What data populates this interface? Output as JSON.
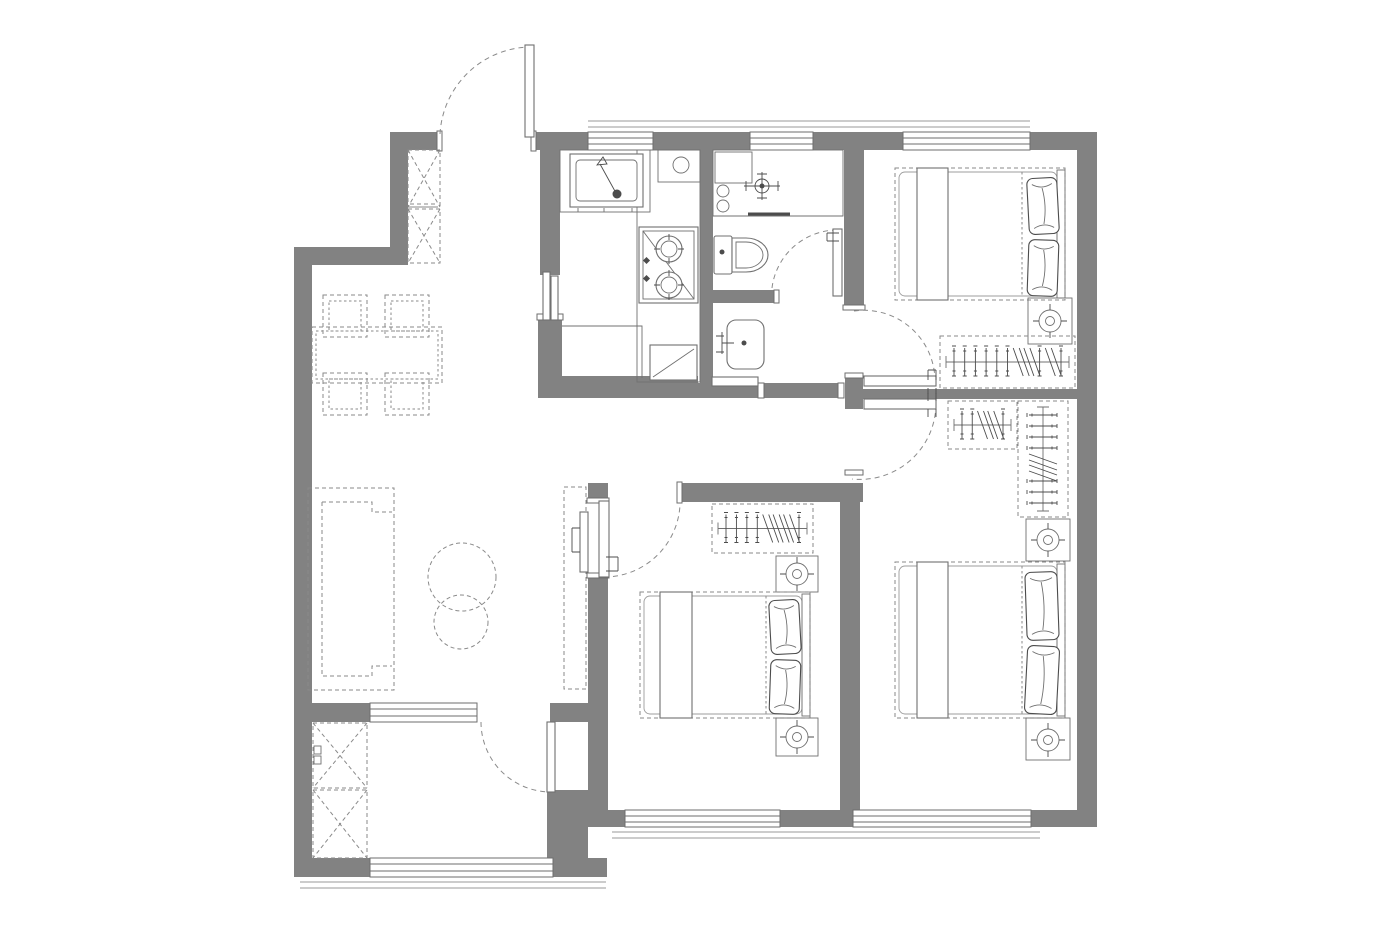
{
  "title": "apartment-floor-plan",
  "colors": {
    "background": "#ffffff",
    "wall": "#828282",
    "wall_edge": "#6e6e6e",
    "line": "#707070",
    "dark_line": "#4c4c4c",
    "dash": "#8a8a8a",
    "sill": "#9a9a9a"
  },
  "plan": {
    "rooms": [
      {
        "name": "entry"
      },
      {
        "name": "kitchen"
      },
      {
        "name": "bathroom"
      },
      {
        "name": "wash-niche"
      },
      {
        "name": "hallway"
      },
      {
        "name": "living-dining-room"
      },
      {
        "name": "balcony"
      },
      {
        "name": "bedroom-top-right"
      },
      {
        "name": "bedroom-bottom-right"
      },
      {
        "name": "bedroom-bottom-middle"
      }
    ],
    "doors": [
      {
        "name": "entry-door",
        "type": "swing"
      },
      {
        "name": "kitchen-sliding-door",
        "type": "sliding"
      },
      {
        "name": "bathroom-door",
        "type": "swing"
      },
      {
        "name": "bedroom-top-right-door",
        "type": "swing"
      },
      {
        "name": "bedroom-bottom-right-door",
        "type": "swing"
      },
      {
        "name": "bedroom-bottom-middle-door",
        "type": "swing"
      },
      {
        "name": "balcony-door",
        "type": "swing"
      }
    ],
    "windows": [
      {
        "name": "kitchen-window",
        "side": "north"
      },
      {
        "name": "bathroom-window",
        "side": "north"
      },
      {
        "name": "bedroom-top-right-window",
        "side": "north"
      },
      {
        "name": "living-balcony-window",
        "side": "south"
      },
      {
        "name": "balcony-window",
        "side": "south"
      },
      {
        "name": "bedroom-bottom-middle-window",
        "side": "south"
      },
      {
        "name": "bedroom-bottom-right-window",
        "side": "south"
      }
    ],
    "fixtures": [
      {
        "name": "shoe-cabinet",
        "room": "entry"
      },
      {
        "name": "kitchen-sink",
        "room": "kitchen"
      },
      {
        "name": "cooktop-two-burners",
        "room": "kitchen"
      },
      {
        "name": "kitchen-counter",
        "room": "kitchen"
      },
      {
        "name": "laundry-counter",
        "room": "bathroom"
      },
      {
        "name": "faucet",
        "room": "bathroom"
      },
      {
        "name": "toilet",
        "room": "bathroom"
      },
      {
        "name": "wash-basin",
        "room": "wash-niche"
      },
      {
        "name": "dining-table",
        "room": "living-dining-room"
      },
      {
        "name": "dining-chairs",
        "count": 4,
        "room": "living-dining-room"
      },
      {
        "name": "sofa",
        "room": "living-dining-room"
      },
      {
        "name": "coffee-table-round-large",
        "room": "living-dining-room"
      },
      {
        "name": "coffee-table-round-small",
        "room": "living-dining-room"
      },
      {
        "name": "tv-cabinet",
        "room": "living-dining-room"
      },
      {
        "name": "tv",
        "room": "living-dining-room"
      },
      {
        "name": "storage-cabinet",
        "room": "balcony"
      },
      {
        "name": "double-bed",
        "room": "bedroom-top-right"
      },
      {
        "name": "wardrobe",
        "room": "bedroom-top-right"
      },
      {
        "name": "nightstand-with-lamp",
        "room": "bedroom-top-right"
      },
      {
        "name": "double-bed",
        "room": "bedroom-bottom-right"
      },
      {
        "name": "wardrobe-2x",
        "room": "bedroom-bottom-right"
      },
      {
        "name": "nightstand-with-lamp-2x",
        "room": "bedroom-bottom-right"
      },
      {
        "name": "double-bed",
        "room": "bedroom-bottom-middle"
      },
      {
        "name": "wardrobe",
        "room": "bedroom-bottom-middle"
      },
      {
        "name": "nightstand-with-lamp-2x",
        "room": "bedroom-bottom-middle"
      }
    ]
  }
}
